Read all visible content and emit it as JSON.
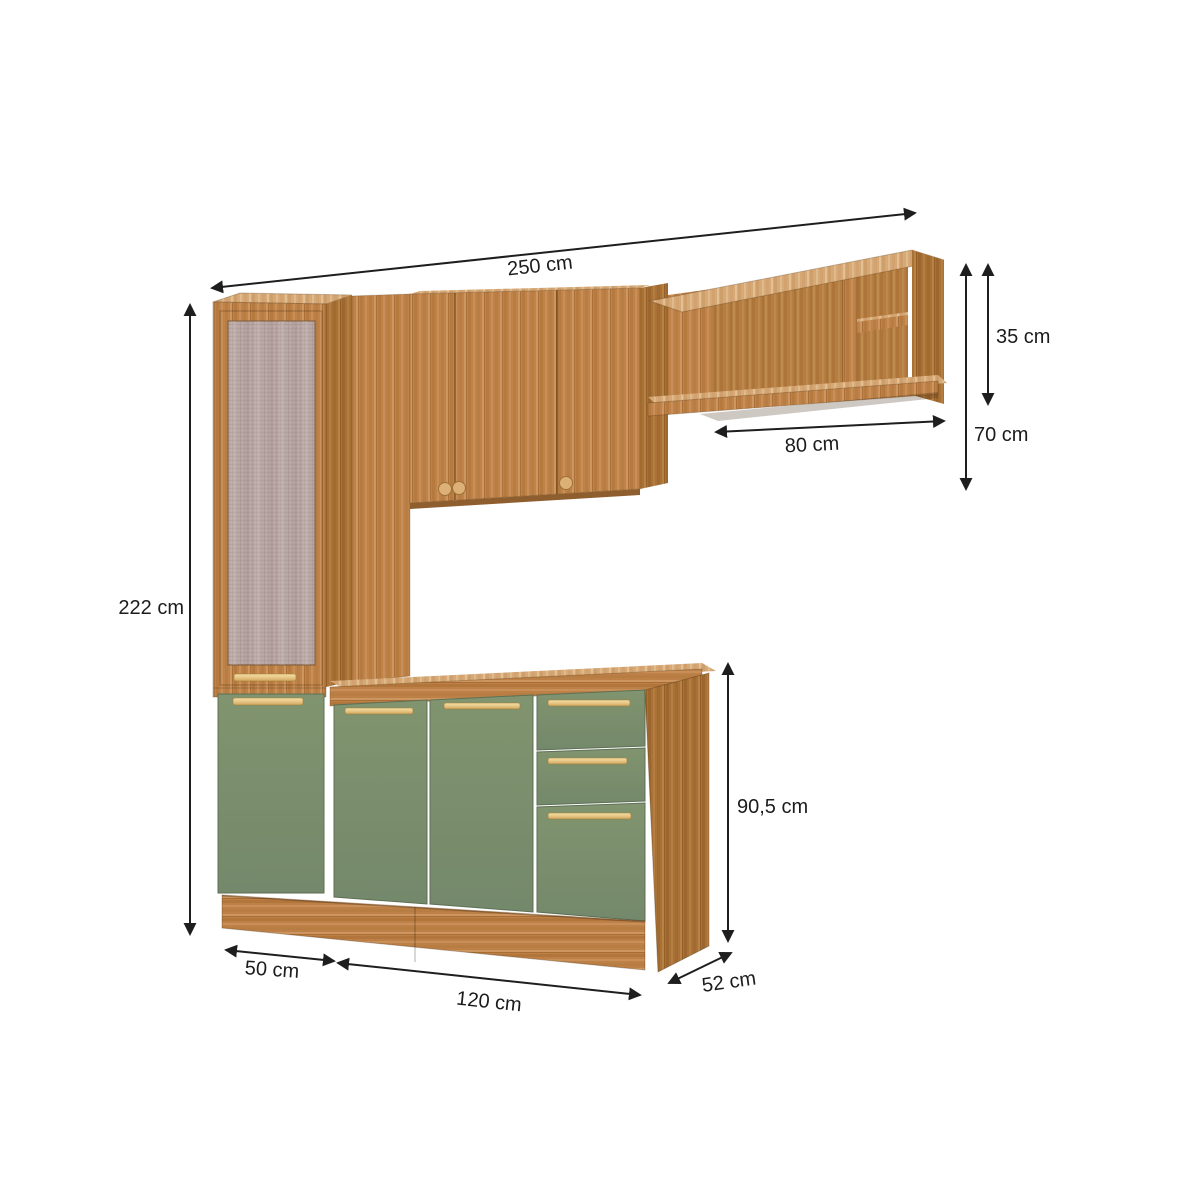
{
  "page": {
    "kind": "furniture-dimension-diagram",
    "subject": "Modular kitchen cabinet set with tall pantry, wall cabinets, open shelf unit and green base cabinet",
    "background": "#ffffff"
  },
  "colors": {
    "wood": "#bf8349",
    "wood_dark": "#a87136",
    "wood_light": "#d6a977",
    "wood_interior": "#b57d42",
    "door_green": "#7b8f70",
    "handle_gold": "#e7c787",
    "mesh_panel": "#b7a6a4",
    "dimension_line": "#1e1e1e"
  },
  "measurements": {
    "total_width": {
      "value": 250,
      "unit": "cm",
      "label": "250 cm"
    },
    "upper_compartment_height": {
      "value": 35,
      "unit": "cm",
      "label": "35 cm"
    },
    "upper_unit_height": {
      "value": 70,
      "unit": "cm",
      "label": "70 cm"
    },
    "wall_shelf_width": {
      "value": 80,
      "unit": "cm",
      "label": "80 cm"
    },
    "total_height": {
      "value": 222,
      "unit": "cm",
      "label": "222 cm"
    },
    "base_unit_height": {
      "value": 90.5,
      "unit": "cm",
      "label": "90,5 cm"
    },
    "tall_cabinet_width": {
      "value": 50,
      "unit": "cm",
      "label": "50 cm"
    },
    "base_cabinet_width": {
      "value": 120,
      "unit": "cm",
      "label": "120 cm"
    },
    "cabinet_depth": {
      "value": 52,
      "unit": "cm",
      "label": "52 cm"
    }
  }
}
